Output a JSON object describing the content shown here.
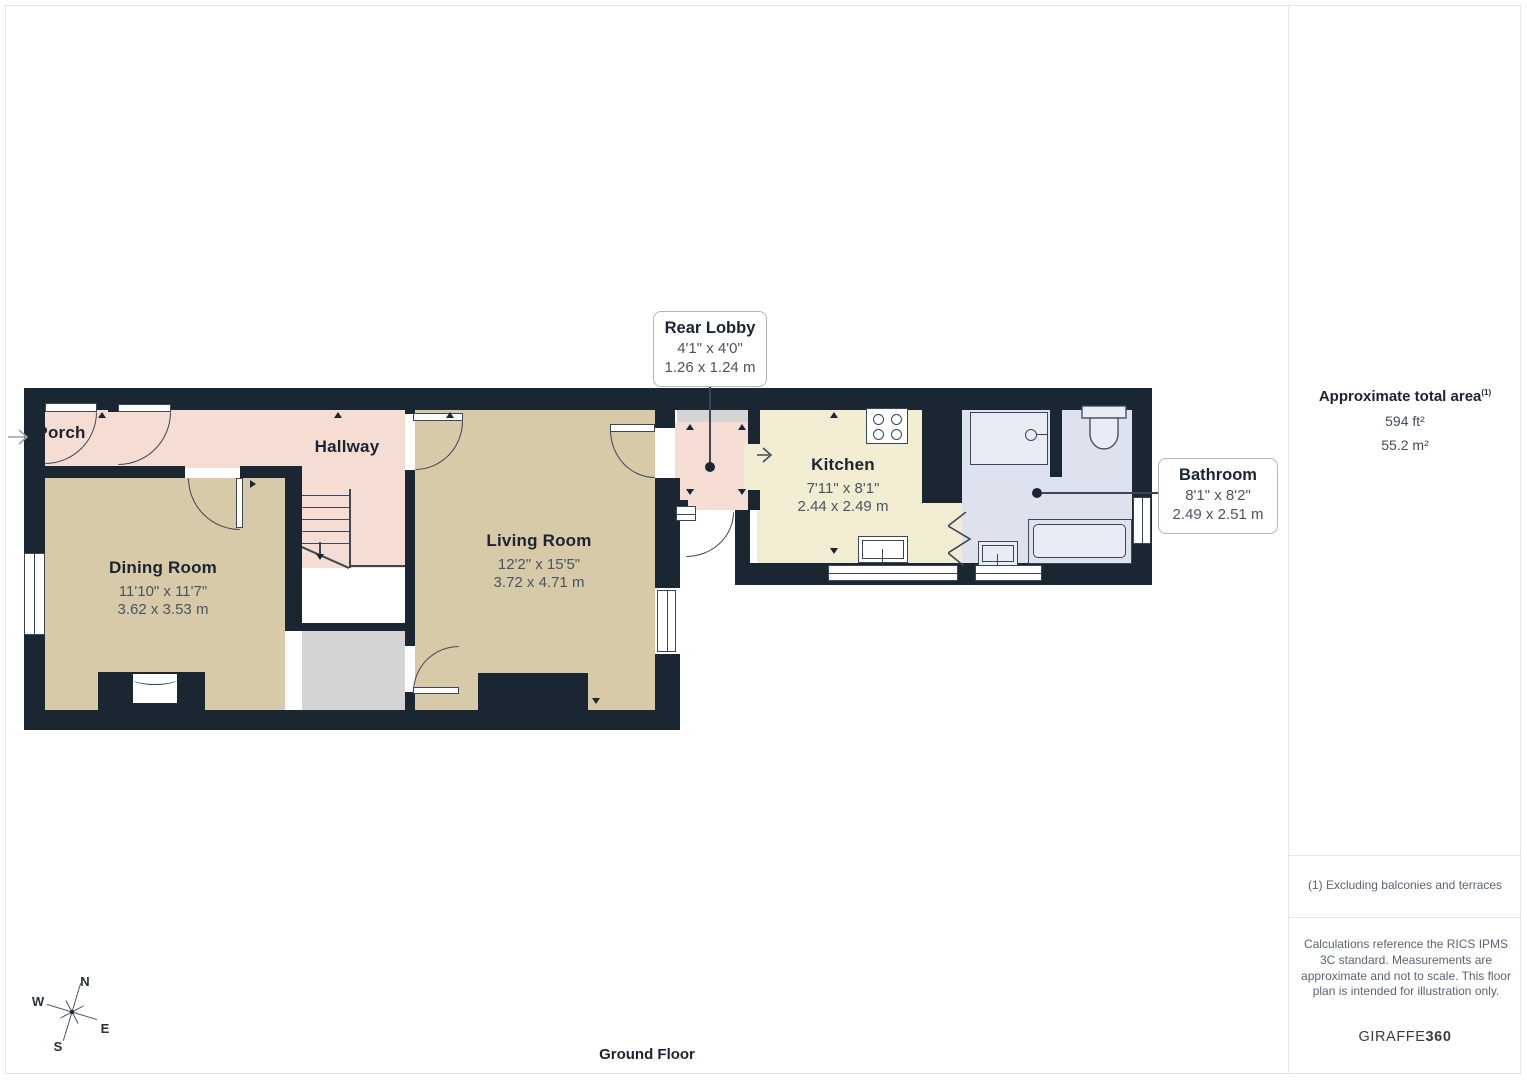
{
  "colors": {
    "wall": "#1b2633",
    "line": "#3c4654",
    "hall": "#f6ddd4",
    "room": "#d6caa8",
    "kitchen": "#f2ecd3",
    "bath": "#dee2ee",
    "gray": "#d4d4d4",
    "fixture": "#e9ecf4",
    "text-dark": "#1b2430",
    "text-dim": "#4a5464",
    "muted": "#5a6372"
  },
  "plan": {
    "floor_label": "Ground Floor",
    "rooms": [
      {
        "label": "Porch"
      },
      {
        "label": "Hallway"
      },
      {
        "label": "Dining Room",
        "imperial": "11'10\" x 11'7\"",
        "metric": "3.62 x 3.53 m"
      },
      {
        "label": "Living Room",
        "imperial": "12'2\" x 15'5\"",
        "metric": "3.72 x 4.71 m"
      },
      {
        "label": "Kitchen",
        "imperial": "7'11\" x 8'1\"",
        "metric": "2.44 x 2.49 m"
      }
    ],
    "callouts": [
      {
        "label": "Rear Lobby",
        "imperial": "4'1\" x 4'0\"",
        "metric": "1.26 x 1.24 m"
      },
      {
        "label": "Bathroom",
        "imperial": "8'1\" x 8'2\"",
        "metric": "2.49 x 2.51 m"
      }
    ],
    "compass": {
      "n": "N",
      "e": "E",
      "s": "S",
      "w": "W"
    }
  },
  "sidebar": {
    "area_title": "Approximate total area",
    "area_marker": "(1)",
    "area_ft": "594 ft²",
    "area_m": "55.2 m²",
    "footnote": "(1) Excluding balconies and terraces",
    "disclaimer": "Calculations reference the RICS IPMS 3C standard. Measurements are approximate and not to scale. This floor plan is intended for illustration only.",
    "brand_name": "GIRAFFE",
    "brand_suffix": "360"
  }
}
